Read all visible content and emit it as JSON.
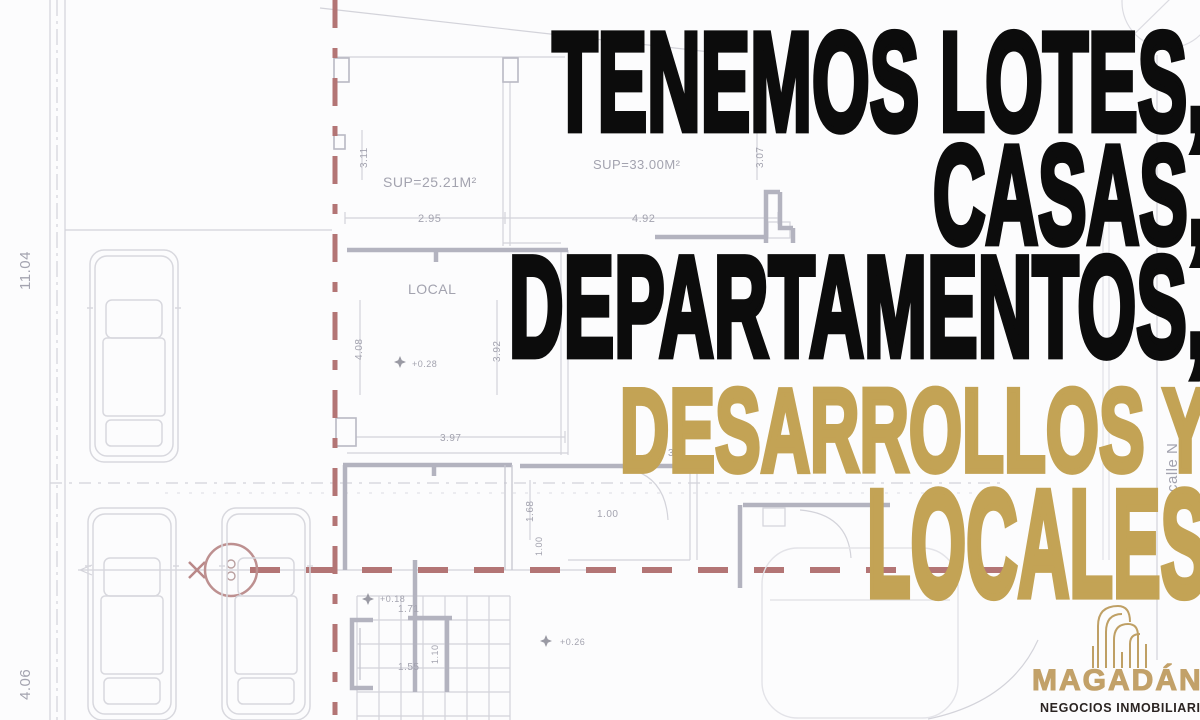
{
  "headline": {
    "lines": [
      {
        "text": "TENEMOS LOTES,",
        "color": "#0c0c0c"
      },
      {
        "text": "CASAS,",
        "color": "#0c0c0c"
      },
      {
        "text": "DEPARTAMENTOS,",
        "color": "#0c0c0c"
      },
      {
        "text": "DESARROLLOS Y",
        "color": "#c3a355"
      },
      {
        "text": "LOCALES",
        "color": "#c3a355"
      }
    ]
  },
  "brand": {
    "name": "MAGADÁN",
    "tagline": "NEGOCIOS INMOBILIARIOS",
    "icon": "building-outline-icon",
    "gold": "#c2a169",
    "dark": "#2b2422"
  },
  "floorplan": {
    "accent_red": "#b37575",
    "line_gray": "#d3d3da",
    "labels": [
      {
        "text": "11.04",
        "x": 30,
        "y": 290,
        "rot": -90,
        "size": 15
      },
      {
        "text": "4.06",
        "x": 30,
        "y": 700,
        "rot": -90,
        "size": 15
      },
      {
        "text": "SUP=25.21M²",
        "x": 383,
        "y": 187,
        "size": 14,
        "dark": true
      },
      {
        "text": "SUP=33.00M²",
        "x": 593,
        "y": 169,
        "size": 13,
        "dark": true
      },
      {
        "text": "LOCAL",
        "x": 408,
        "y": 294,
        "size": 14,
        "dark": true
      },
      {
        "text": "2.95",
        "x": 418,
        "y": 222,
        "size": 11
      },
      {
        "text": "4.92",
        "x": 632,
        "y": 222,
        "size": 11
      },
      {
        "text": "3.11",
        "x": 367,
        "y": 168,
        "rot": -90,
        "size": 10
      },
      {
        "text": "3.07",
        "x": 763,
        "y": 168,
        "rot": -90,
        "size": 10
      },
      {
        "text": "4.08",
        "x": 362,
        "y": 360,
        "rot": -90,
        "size": 10
      },
      {
        "text": "3.92",
        "x": 500,
        "y": 362,
        "rot": -90,
        "size": 10
      },
      {
        "text": "3.97",
        "x": 440,
        "y": 441,
        "size": 10
      },
      {
        "text": "1.68",
        "x": 533,
        "y": 522,
        "rot": -90,
        "size": 10
      },
      {
        "text": "1.00",
        "x": 542,
        "y": 556,
        "rot": -90,
        "size": 9
      },
      {
        "text": "1.00",
        "x": 597,
        "y": 517,
        "size": 10
      },
      {
        "text": "37",
        "x": 668,
        "y": 456,
        "size": 10
      },
      {
        "text": "1.71",
        "x": 398,
        "y": 612,
        "size": 10
      },
      {
        "text": "1.55",
        "x": 398,
        "y": 670,
        "size": 10
      },
      {
        "text": "1.10",
        "x": 438,
        "y": 664,
        "rot": -90,
        "size": 9
      },
      {
        "text": "+0.28",
        "x": 412,
        "y": 367,
        "size": 9
      },
      {
        "text": "+0.18",
        "x": 380,
        "y": 602,
        "size": 9
      },
      {
        "text": "+0.26",
        "x": 560,
        "y": 645,
        "size": 9
      },
      {
        "text": "calle N",
        "x": 1177,
        "y": 492,
        "rot": -90,
        "size": 15,
        "dark": true
      }
    ]
  }
}
